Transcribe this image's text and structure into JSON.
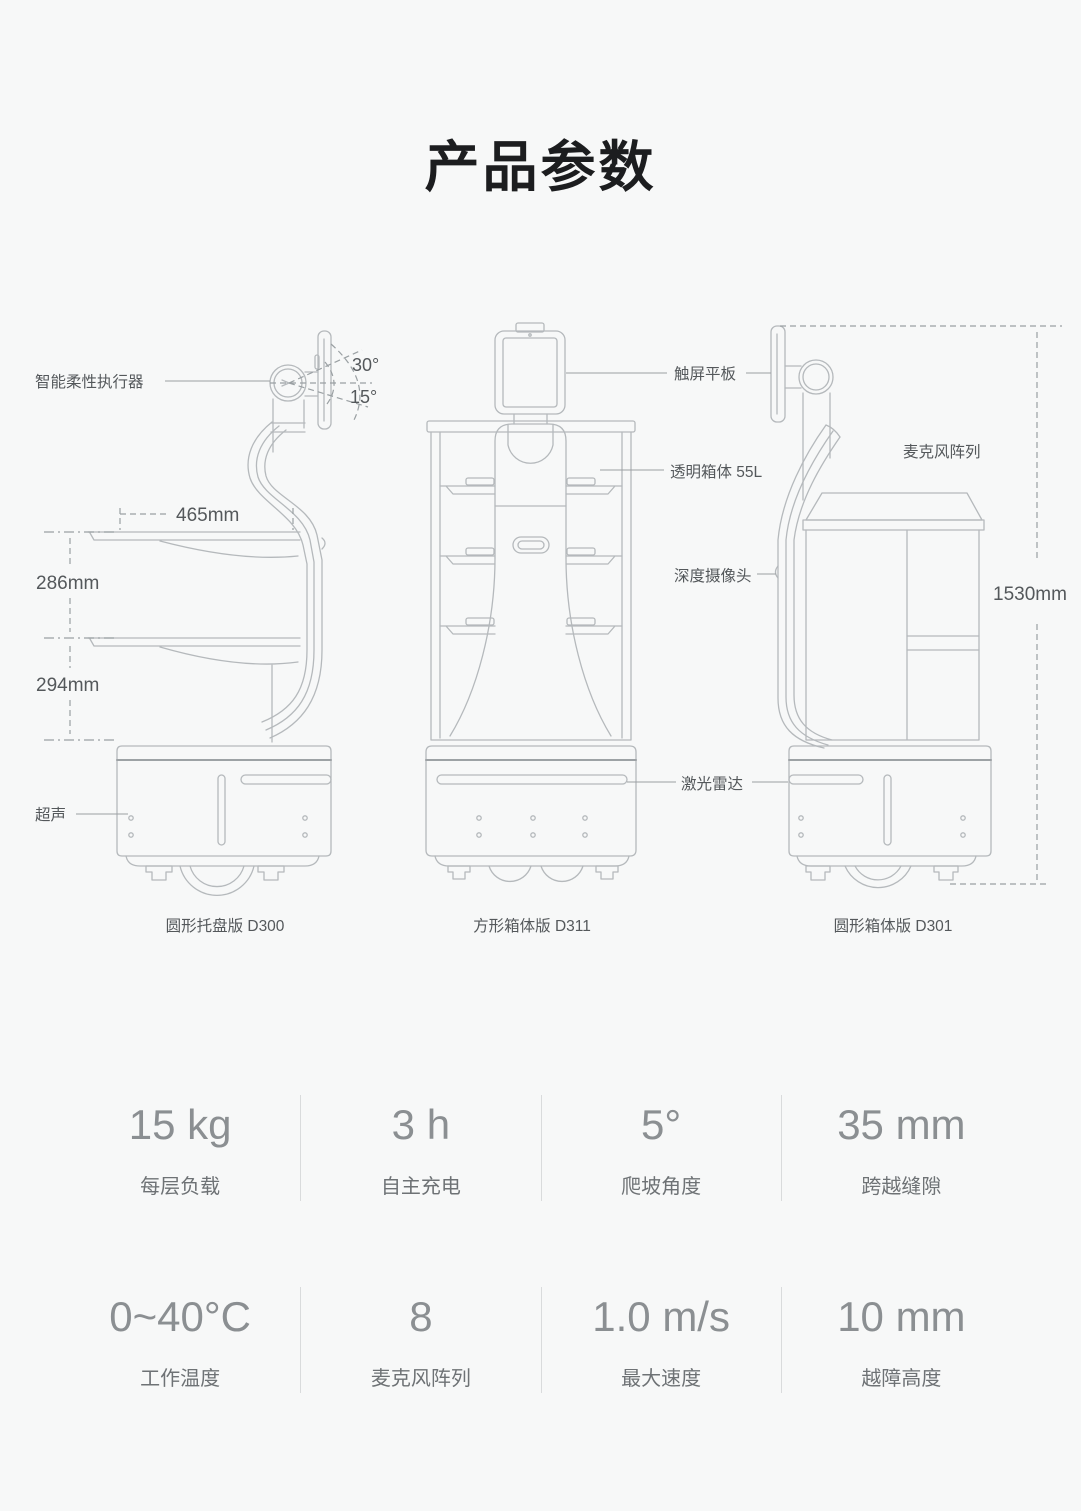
{
  "page": {
    "title": "产品参数"
  },
  "diagram": {
    "robots": [
      {
        "caption": "圆形托盘版 D300"
      },
      {
        "caption": "方形箱体版 D311"
      },
      {
        "caption": "圆形箱体版 D301"
      }
    ],
    "callouts": {
      "actuator": "智能柔性执行器",
      "angle_up": "30°",
      "angle_down": "15°",
      "ultrasonic": "超声",
      "touchscreen": "触屏平板",
      "transparent_box": "透明箱体 55L",
      "depth_camera": "深度摄像头",
      "lidar": "激光雷达",
      "mic_array": "麦克风阵列"
    },
    "dimensions": {
      "tray_width": "465mm",
      "tray_gap_upper": "286mm",
      "tray_gap_lower": "294mm",
      "total_height": "1530mm"
    }
  },
  "specs": {
    "cells": [
      {
        "value": "15 kg",
        "label": "每层负载"
      },
      {
        "value": "3 h",
        "label": "自主充电"
      },
      {
        "value": "5°",
        "label": "爬坡角度"
      },
      {
        "value": "35 mm",
        "label": "跨越缝隙"
      },
      {
        "value": "0~40°C",
        "label": "工作温度"
      },
      {
        "value": "8",
        "label": "麦克风阵列"
      },
      {
        "value": "1.0 m/s",
        "label": "最大速度"
      },
      {
        "value": "10 mm",
        "label": "越障高度"
      }
    ]
  }
}
